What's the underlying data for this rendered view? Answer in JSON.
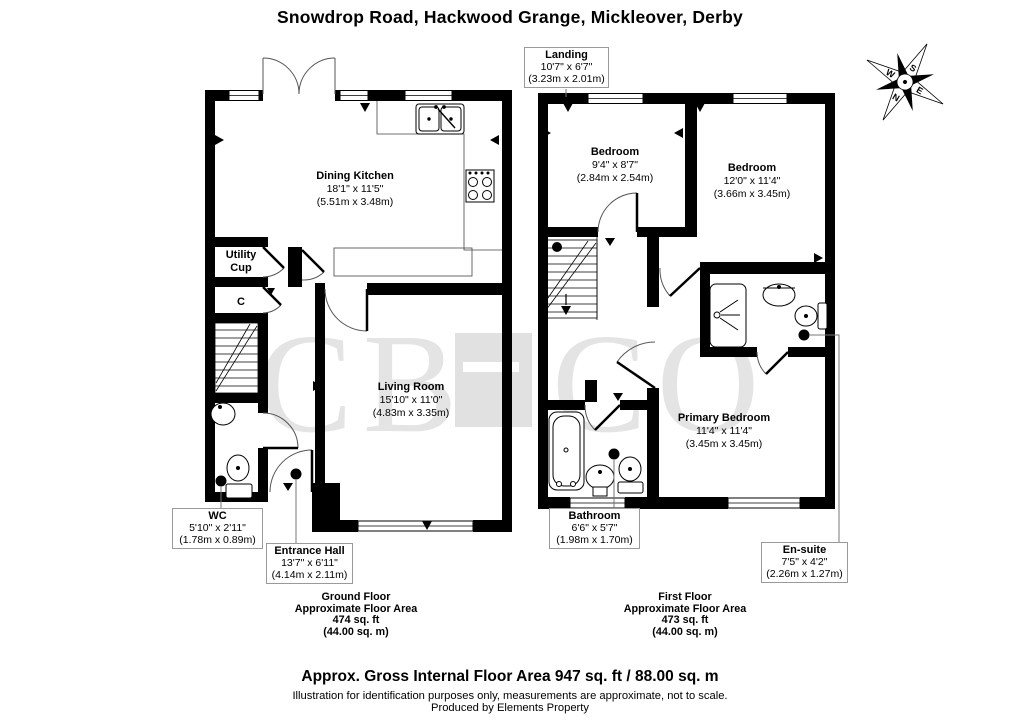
{
  "title": "Snowdrop Road, Hackwood Grange, Mickleover, Derby",
  "watermark": {
    "left": "CB",
    "right": "CO"
  },
  "compass": {
    "top": "S",
    "bottom": "N",
    "left": "W",
    "right": "E"
  },
  "ground_floor": {
    "dining_kitchen": {
      "name": "Dining Kitchen",
      "dims": "18'1\" x 11'5\"",
      "metric": "(5.51m x 3.48m)"
    },
    "utility": {
      "line1": "Utility",
      "line2": "Cup"
    },
    "cupboard": {
      "name": "C"
    },
    "living_room": {
      "name": "Living Room",
      "dims": "15'10\" x 11'0\"",
      "metric": "(4.83m x 3.35m)"
    },
    "wc": {
      "name": "WC",
      "dims": "5'10\" x 2'11\"",
      "metric": "(1.78m x 0.89m)"
    },
    "entrance_hall": {
      "name": "Entrance Hall",
      "dims": "13'7\" x 6'11\"",
      "metric": "(4.14m x 2.11m)"
    },
    "caption": {
      "floor": "Ground Floor",
      "area_label": "Approximate Floor Area",
      "area_ft": "474 sq. ft",
      "area_m": "(44.00 sq. m)"
    }
  },
  "first_floor": {
    "landing": {
      "name": "Landing",
      "dims": "10'7\" x 6'7\"",
      "metric": "(3.23m x 2.01m)"
    },
    "bedroom_1": {
      "name": "Bedroom",
      "dims": "9'4\" x 8'7\"",
      "metric": "(2.84m x 2.54m)"
    },
    "bedroom_2": {
      "name": "Bedroom",
      "dims": "12'0\" x 11'4\"",
      "metric": "(3.66m x 3.45m)"
    },
    "primary_bedroom": {
      "name": "Primary Bedroom",
      "dims": "11'4\" x 11'4\"",
      "metric": "(3.45m x 3.45m)"
    },
    "bathroom": {
      "name": "Bathroom",
      "dims": "6'6\" x 5'7\"",
      "metric": "(1.98m x 1.70m)"
    },
    "ensuite": {
      "name": "En-suite",
      "dims": "7'5\" x 4'2\"",
      "metric": "(2.26m x 1.27m)"
    },
    "caption": {
      "floor": "First Floor",
      "area_label": "Approximate Floor Area",
      "area_ft": "473 sq. ft",
      "area_m": "(44.00 sq. m)"
    }
  },
  "footer": {
    "total": "Approx. Gross Internal Floor Area 947 sq. ft / 88.00 sq. m",
    "disclaimer": "Illustration for identification purposes only, measurements are approximate, not to scale.",
    "credit": "Produced by Elements Property"
  }
}
